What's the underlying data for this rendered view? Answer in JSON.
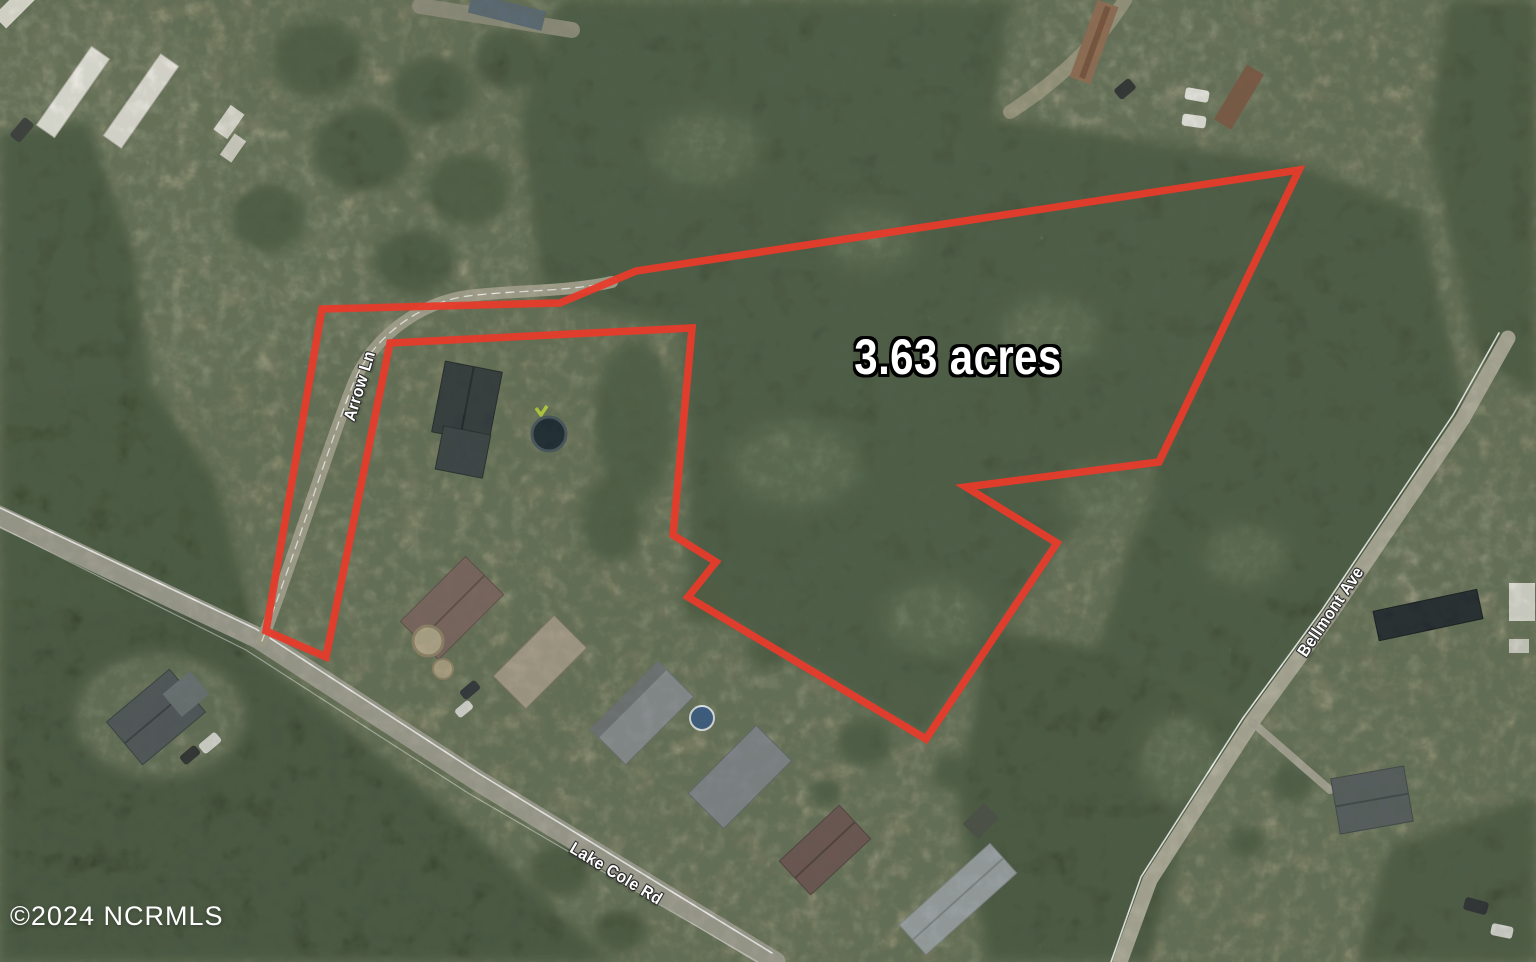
{
  "map": {
    "area_label": "3.63 acres",
    "road_labels": {
      "arrow_ln": "Arrow Ln",
      "lake_cole_rd": "Lake Cole Rd",
      "bellmont_ave": "Bellmont Ave"
    },
    "watermark": "©2024 NCRMLS"
  },
  "colors": {
    "boundary": "#e73b2b",
    "label_text": "#ffffff"
  }
}
